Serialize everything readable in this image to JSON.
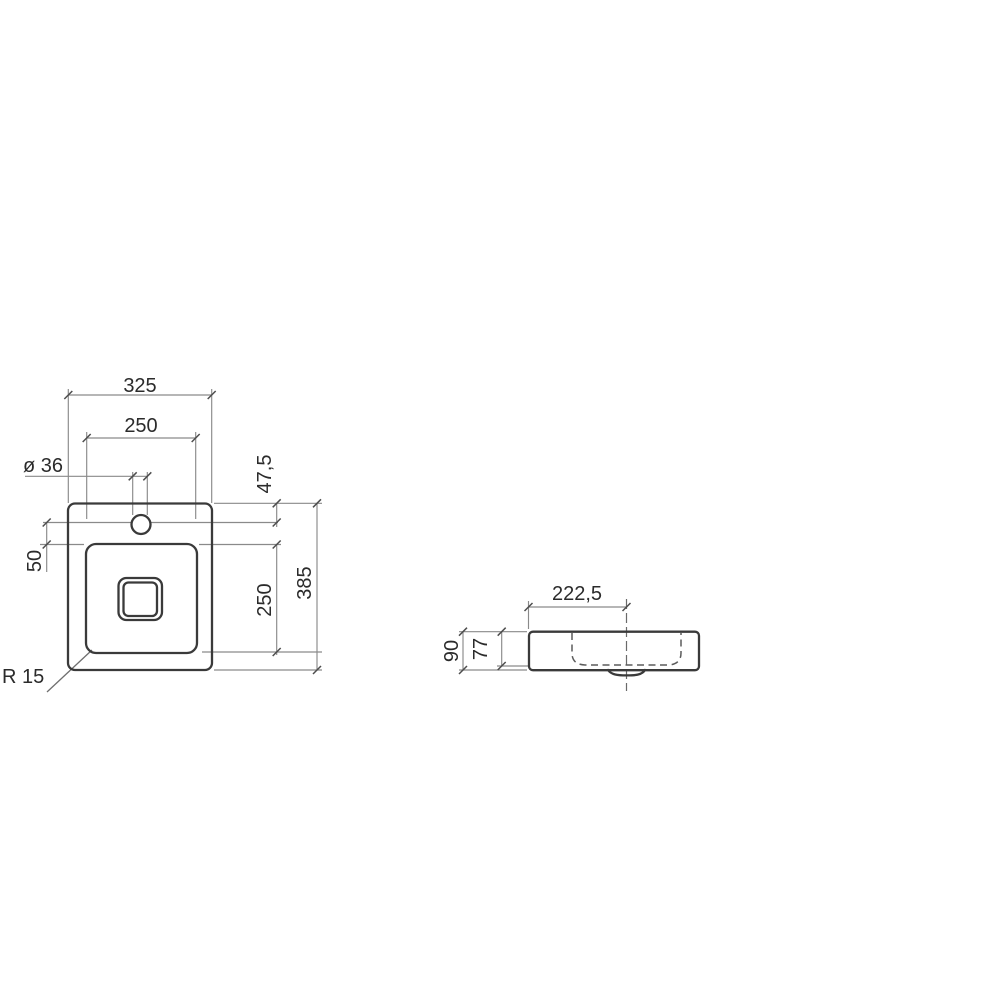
{
  "drawing": {
    "type": "technical-dimension-drawing",
    "plan_view": {
      "dim_overall_width": "325",
      "dim_basin_width": "250",
      "dim_hole_diameter": "ø 36",
      "dim_hole_offset": "47,5",
      "dim_hole_to_basin": "50",
      "dim_basin_depth": "250",
      "dim_overall_depth": "385",
      "dim_corner_radius": "R 15"
    },
    "side_view": {
      "dim_drain_offset": "222,5",
      "dim_overall_height": "90",
      "dim_basin_inner_depth": "77"
    },
    "colors": {
      "background": "#ffffff",
      "object_line": "#3a3a3a",
      "dimension_line": "#8a8a8a",
      "hidden_line": "#5c5c5c",
      "text": "#2b2b2b"
    }
  }
}
